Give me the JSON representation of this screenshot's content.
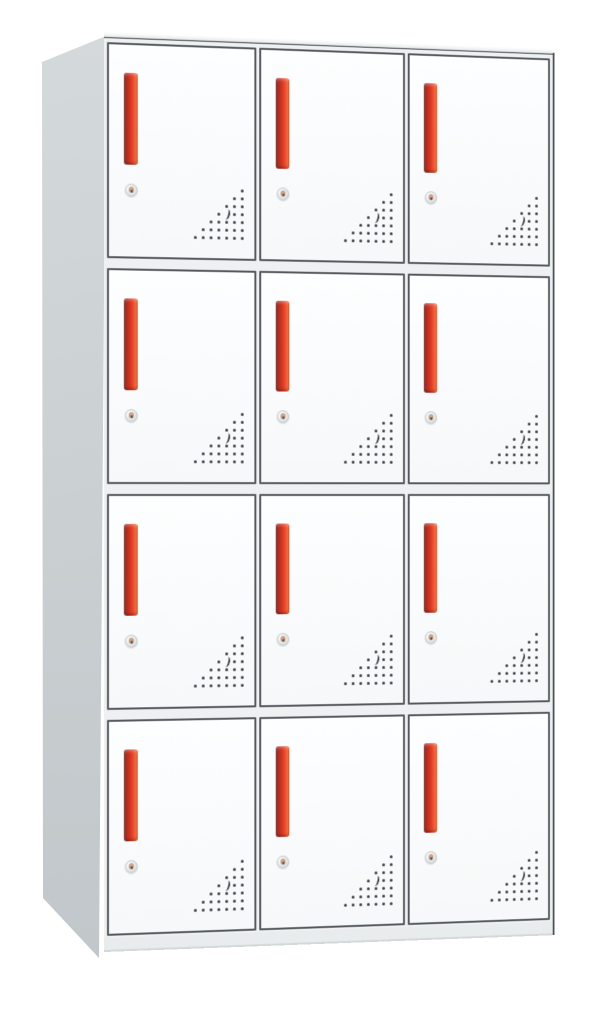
{
  "meta": {
    "description": "Product photo of a 12-compartment steel office locker cabinet with red handles, on a plain white background",
    "background_color": "#ffffff"
  },
  "cabinet": {
    "rows": 4,
    "columns": 3,
    "door_count": 12,
    "colors": {
      "background": "#ffffff",
      "front_frame": "#eef0f1",
      "outline": "#4e5356",
      "side_panel_top": "#d4d9db",
      "side_panel_bottom": "#c1c7ca",
      "door_fill": "#fdfeff",
      "door_border": "#54595d",
      "plinth": "#e9ecec",
      "handle_red": "#d63420",
      "handle_dark": "#8e241a",
      "handle_light": "#f0703e",
      "lock_silver": "#e7ebec",
      "vent_dot": "#3b3f42"
    },
    "door_features": {
      "handle": "vertical red bar handle, top-left of door",
      "lock": "round silver cam lock below handle",
      "vents": "triangular perforation pattern, bottom-right of door"
    },
    "vents": {
      "rows": 7,
      "spacing_px": 8,
      "dot_px": 3,
      "pattern": "right-triangle, dots right-aligned, one dot per row increasing downward",
      "crescent_row": 3,
      "crescent_from_right": 2
    },
    "doors": [
      {
        "row": 1,
        "col": 1
      },
      {
        "row": 1,
        "col": 2
      },
      {
        "row": 1,
        "col": 3
      },
      {
        "row": 2,
        "col": 1
      },
      {
        "row": 2,
        "col": 2
      },
      {
        "row": 2,
        "col": 3
      },
      {
        "row": 3,
        "col": 1
      },
      {
        "row": 3,
        "col": 2
      },
      {
        "row": 3,
        "col": 3
      },
      {
        "row": 4,
        "col": 1
      },
      {
        "row": 4,
        "col": 2
      },
      {
        "row": 4,
        "col": 3
      }
    ]
  }
}
